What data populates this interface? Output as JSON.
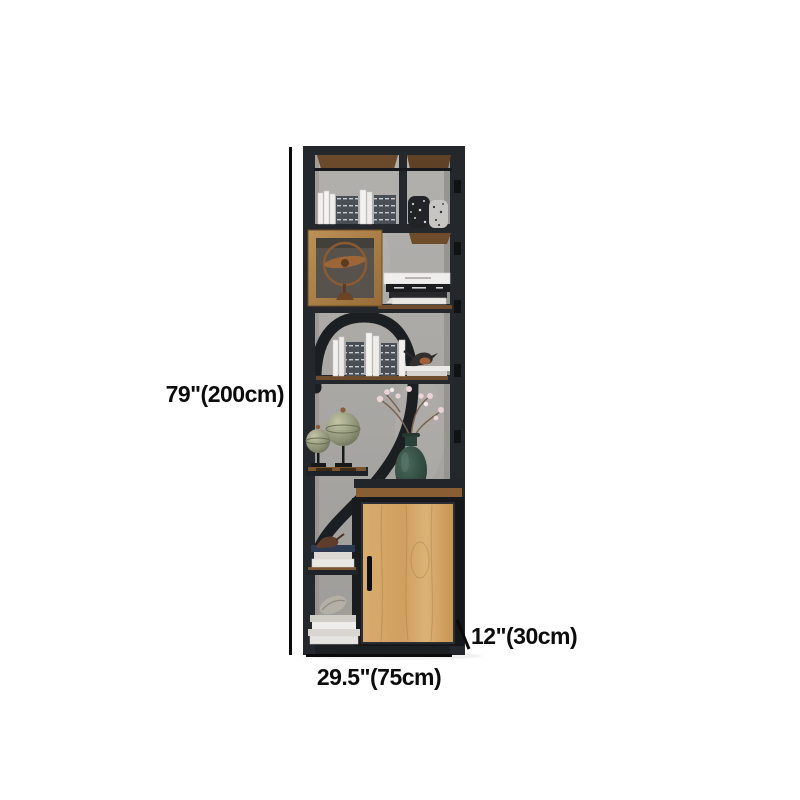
{
  "canvas": {
    "background": "#ffffff"
  },
  "annotations": {
    "height": "79\"(200cm)",
    "width": "29.5\"(75cm)",
    "depth": "12\"(30cm)"
  },
  "product": {
    "type": "industrial metal-and-wood bookshelf with lower cabinet",
    "colors": {
      "frame": "#24272b",
      "back_wall": "#a9a7a4",
      "shelf_wood": "#6b4a2b",
      "display_cube_wood": "#a87c45",
      "cabinet_door_wood": "#d2a263",
      "globe_green": "#8d9175",
      "vase_green": "#2e4a40",
      "blossom_pink": "#ecd3d8",
      "bronze": "#8a5a33",
      "annotation_line": "#0a0a0a"
    },
    "visible_items": [
      "white-and-striped-books",
      "speckled-decor-vases",
      "wood-display-cube-with-bronze-gyroscope",
      "curved-metal-arch",
      "bird-figurines",
      "metal-globes-on-stands",
      "green-vase-with-blossom-branches",
      "wood-cabinet-door-with-black-handle",
      "stacked-books-with-shell-ornament"
    ]
  }
}
